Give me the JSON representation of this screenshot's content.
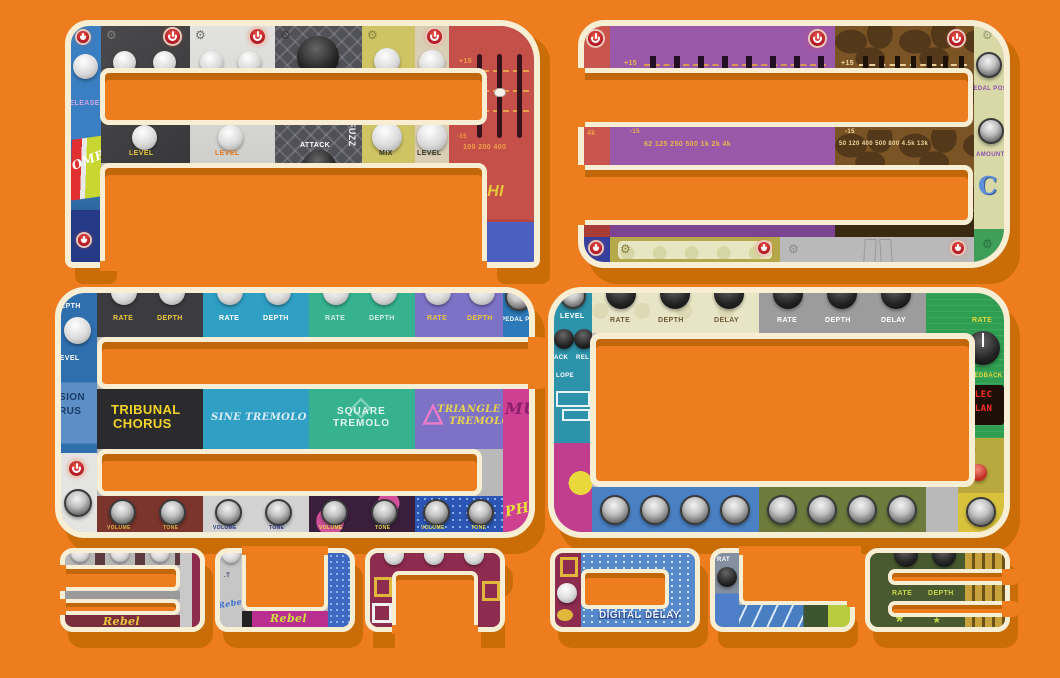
{
  "title": "A360 BUNDLE",
  "headline": {
    "glyphs": [
      "A",
      "3",
      "6",
      "0"
    ],
    "word": "BUNDLE",
    "letters": [
      "B",
      "U",
      "N",
      "D",
      "L",
      "E"
    ]
  },
  "colors": {
    "background": "#ee7d20",
    "shadow": "#cb6d06",
    "outline": "#f7eed4",
    "slot_inner_shadow": "#c2660a",
    "power_button_red": "#c0202a"
  },
  "icons": {
    "gear": "⚙",
    "triangle": "△",
    "diamond": "◇",
    "sun": "*"
  },
  "glyph_a": {
    "comp": {
      "release": "RELEASE",
      "name": "OMP"
    },
    "knob_labels": [
      "LEVEL",
      "LEVEL",
      "ATTACK",
      "MIX",
      "LEVEL"
    ],
    "fuzz_vertical": "FUZZ",
    "eq": {
      "max": "+15",
      "min": "-15",
      "freqs": "100 200 400",
      "name": "ΔPHI"
    }
  },
  "glyph_3": {
    "sliver": "4k",
    "eq_purple": {
      "max": "+15",
      "min": "-15",
      "freqs": "62  125  250  500   1k    2k    4k"
    },
    "eq_giraffe": {
      "max": "+15",
      "min": "-15",
      "freqs": "50  120  400  500  800  4.5k  13k"
    },
    "spine": {
      "knob1": "PEDAL POS",
      "knob2": "AMOUNT",
      "logo": "C"
    }
  },
  "glyph_6": {
    "left": {
      "depth": "DEPTH",
      "level": "LEVEL",
      "name_top": "SION",
      "name_bottom": "RUS"
    },
    "rate": "RATE",
    "depth": "DEPTH",
    "right_top": "PEDAL PO",
    "names": {
      "tribunal_1": "TRIBUNAL",
      "tribunal_2": "CHORUS",
      "sine": "SINE TREMOLO",
      "square_1": "SQUARE",
      "square_2": "TREMOLO",
      "triangle_1": "TRIANGLE",
      "triangle_2": "TREMOLO",
      "mu": "MU",
      "ph": "PH"
    },
    "bottom": {
      "volume": "VOLUME",
      "tone": "TONE"
    }
  },
  "glyph_0": {
    "left": {
      "level": "LEVEL",
      "attack": "ACK",
      "release": "REL",
      "envelope": "LOPE"
    },
    "rate": "RATE",
    "depth": "DEPTH",
    "delay": "DELAY",
    "right": {
      "rate": "RATE",
      "feedback": "FEEDBACK",
      "display_1": "ELEC",
      "display_2": "FLAN"
    }
  },
  "bundle": {
    "b": {
      "script": "Rebel"
    },
    "u": {
      "label": ".T",
      "script": "Rebel"
    },
    "d": {
      "name_1": "DIGITAL",
      "name_2": "DELAY"
    },
    "l": {
      "rate": "RAT"
    },
    "e": {
      "rate": "RATE",
      "depth": "DEPTH"
    }
  }
}
